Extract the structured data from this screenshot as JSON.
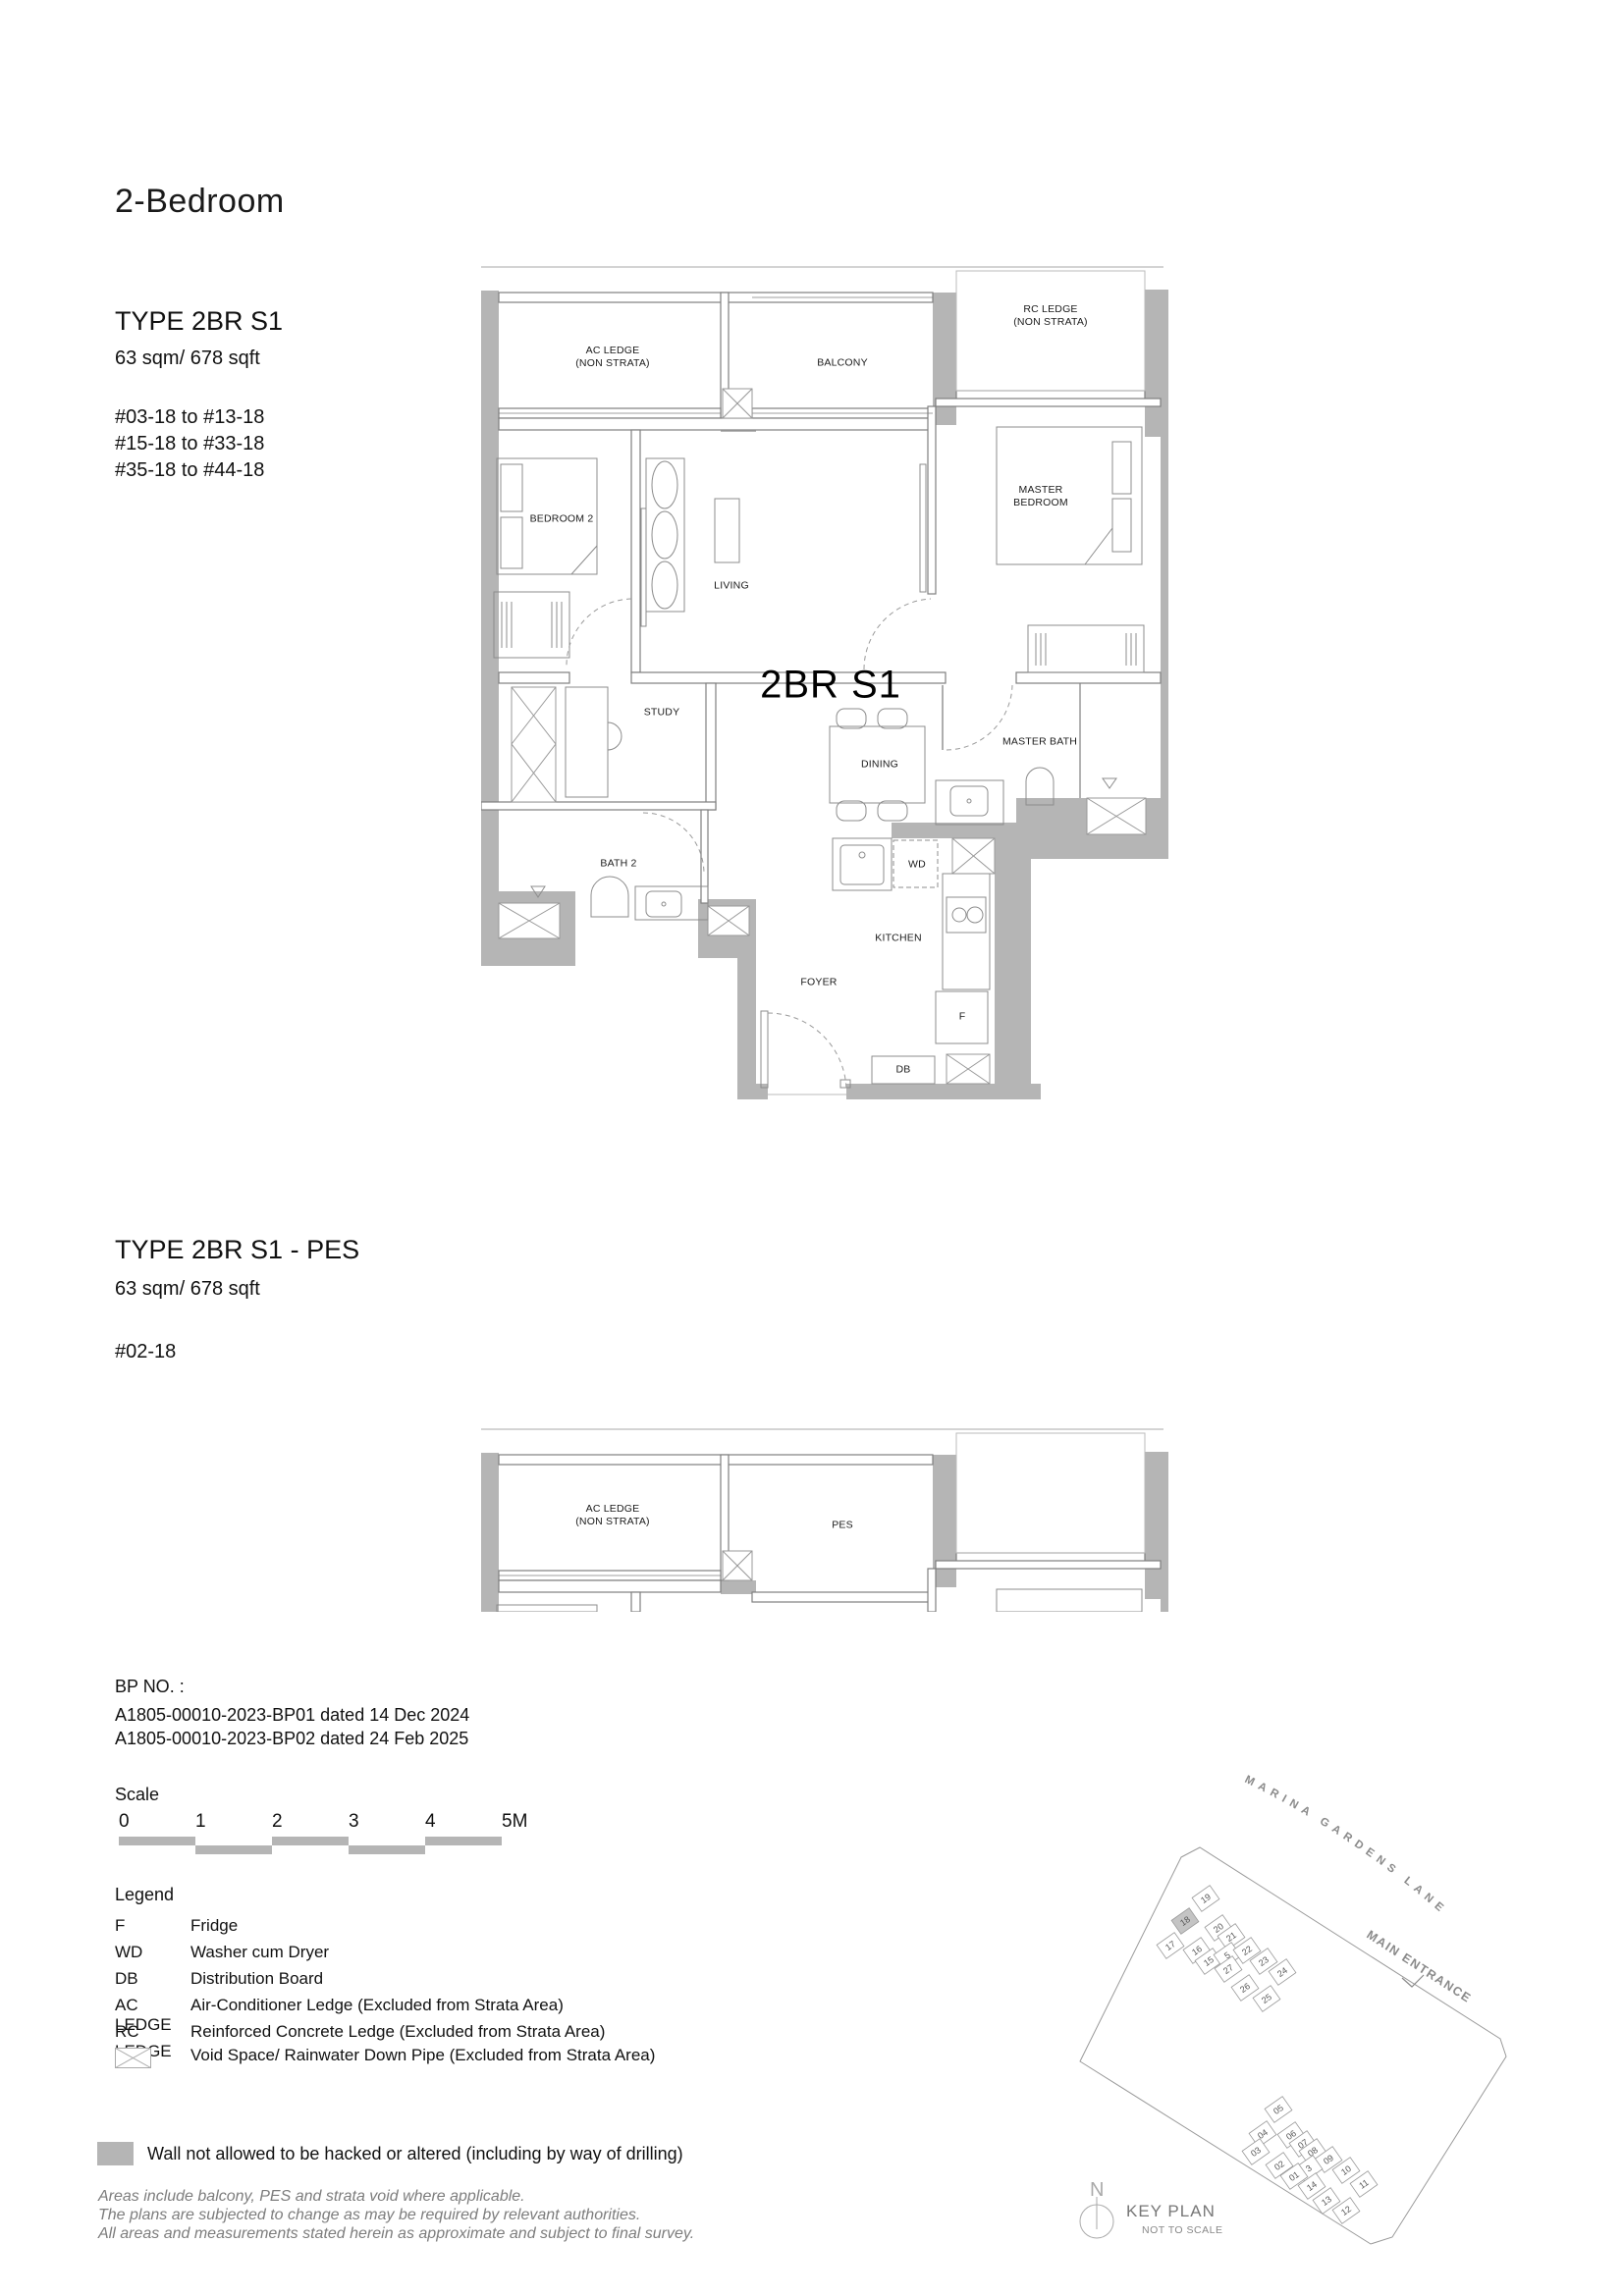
{
  "page_title": "2-Bedroom",
  "type1": {
    "name": "TYPE 2BR S1",
    "area": "63 sqm/ 678 sqft",
    "units": [
      "#03-18 to #13-18",
      "#15-18 to #33-18",
      "#35-18 to #44-18"
    ]
  },
  "type2": {
    "name": "TYPE 2BR S1 - PES",
    "area": "63 sqm/ 678 sqft",
    "units": [
      "#02-18"
    ]
  },
  "plan1": {
    "unit_label": "2BR S1",
    "rooms": {
      "ac_ledge_1": "AC LEDGE",
      "ac_ledge_2": "(NON STRATA)",
      "balcony": "BALCONY",
      "rc_ledge_1": "RC LEDGE",
      "rc_ledge_2": "(NON STRATA)",
      "bedroom2": "BEDROOM 2",
      "living": "LIVING",
      "master_bedroom": "MASTER BEDROOM",
      "study": "STUDY",
      "dining": "DINING",
      "master_bath": "MASTER BATH",
      "bath2": "BATH 2",
      "wd": "WD",
      "kitchen": "KITCHEN",
      "foyer": "FOYER",
      "fridge": "F",
      "db": "DB"
    }
  },
  "plan2": {
    "ac_ledge_1": "AC LEDGE",
    "ac_ledge_2": "(NON STRATA)",
    "pes": "PES"
  },
  "bp": {
    "heading": "BP NO. :",
    "lines": [
      "A1805-00010-2023-BP01 dated 14 Dec 2024",
      "A1805-00010-2023-BP02 dated 24 Feb 2025"
    ]
  },
  "scale": {
    "label": "Scale",
    "ticks": [
      "0",
      "1",
      "2",
      "3",
      "4",
      "5M"
    ]
  },
  "legend": {
    "heading": "Legend",
    "items": [
      {
        "term": "F",
        "desc": "Fridge"
      },
      {
        "term": "WD",
        "desc": "Washer cum Dryer"
      },
      {
        "term": "DB",
        "desc": "Distribution Board"
      },
      {
        "term": "AC LEDGE",
        "desc": "Air-Conditioner Ledge (Excluded from Strata Area)"
      },
      {
        "term": "RC LEDGE",
        "desc": "Reinforced Concrete Ledge (Excluded from Strata Area)"
      }
    ],
    "void_desc": "Void Space/ Rainwater Down Pipe (Excluded from Strata Area)"
  },
  "wall_note": "Wall not allowed to be hacked or altered (including by way of drilling)",
  "disclaimer": [
    "Areas include balcony, PES and strata void where applicable.",
    "The plans are subjected to change as may be required by relevant authorities.",
    "All areas and measurements stated herein as approximate and subject to final survey."
  ],
  "keyplan": {
    "road": "MARINA GARDENS LANE",
    "entrance": "MAIN ENTRANCE",
    "title": "KEY PLAN",
    "subtitle": "NOT TO SCALE",
    "north": "N",
    "highlight_unit": "18",
    "cluster_a": [
      "19",
      "18",
      "17",
      "20",
      "16",
      "21",
      "15",
      "5",
      "22",
      "27",
      "23",
      "26",
      "24",
      "25"
    ],
    "cluster_b": [
      "05",
      "04",
      "06",
      "03",
      "07",
      "08",
      "02",
      "09",
      "3",
      "01",
      "10",
      "14",
      "11",
      "13",
      "12"
    ]
  },
  "colors": {
    "wall_gray": "#b5b5b5",
    "line_gray": "#7f7f7f",
    "text_black": "#111111"
  }
}
